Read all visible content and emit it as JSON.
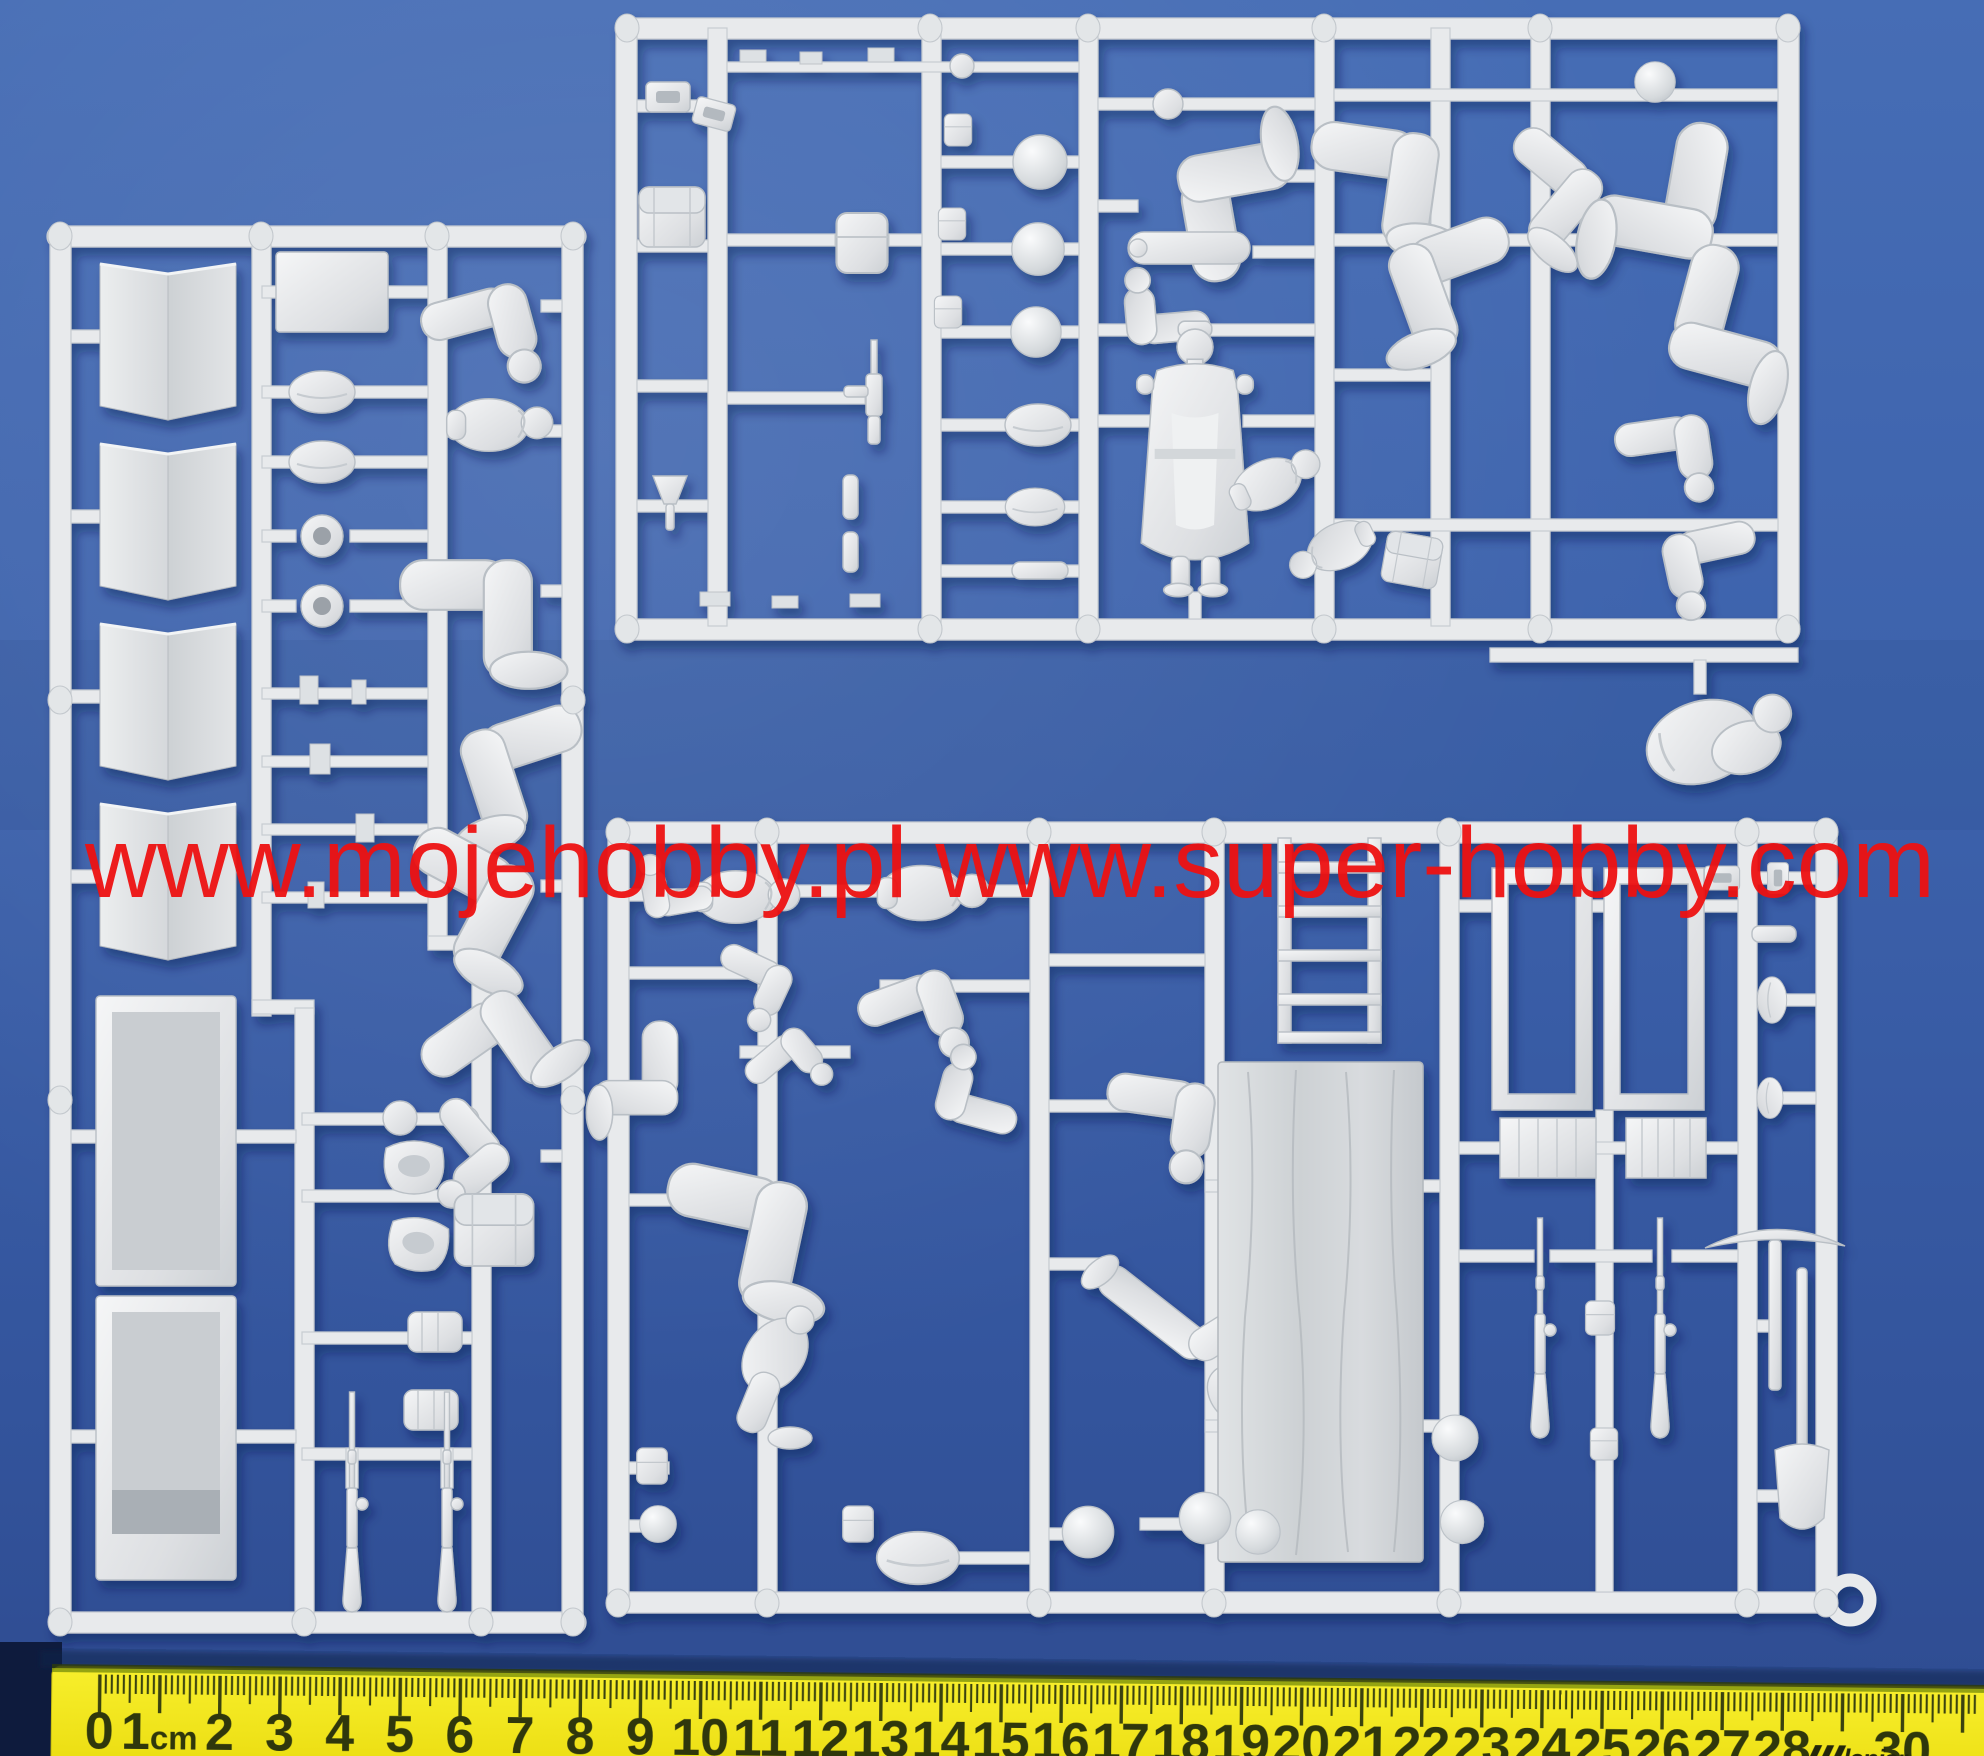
{
  "watermark": {
    "text": "www.mojehobby.pl www.super-hobby.com",
    "color": "#ee1111"
  },
  "ruler": {
    "brand": "leniar",
    "numbers": [
      "0",
      "1cm",
      "2",
      "3",
      "4",
      "5",
      "6",
      "7",
      "8",
      "9",
      "10",
      "11",
      "12",
      "13",
      "14",
      "15",
      "16",
      "17",
      "18",
      "19",
      "20",
      "21",
      "22",
      "23",
      "24",
      "25",
      "26",
      "27",
      "28",
      "logo",
      "30"
    ],
    "start_cm": 0,
    "end_cm": 30,
    "body_color": "#f2e816",
    "digit_color": "#2f370c"
  },
  "scene": {
    "background_color": "#3b60ab",
    "plastic_color": "#e8eaec",
    "sprues": [
      {
        "id": "left",
        "label": "sprue-left"
      },
      {
        "id": "top-right",
        "label": "sprue-top-right"
      },
      {
        "id": "bottom-right",
        "label": "sprue-bottom-right"
      }
    ]
  }
}
